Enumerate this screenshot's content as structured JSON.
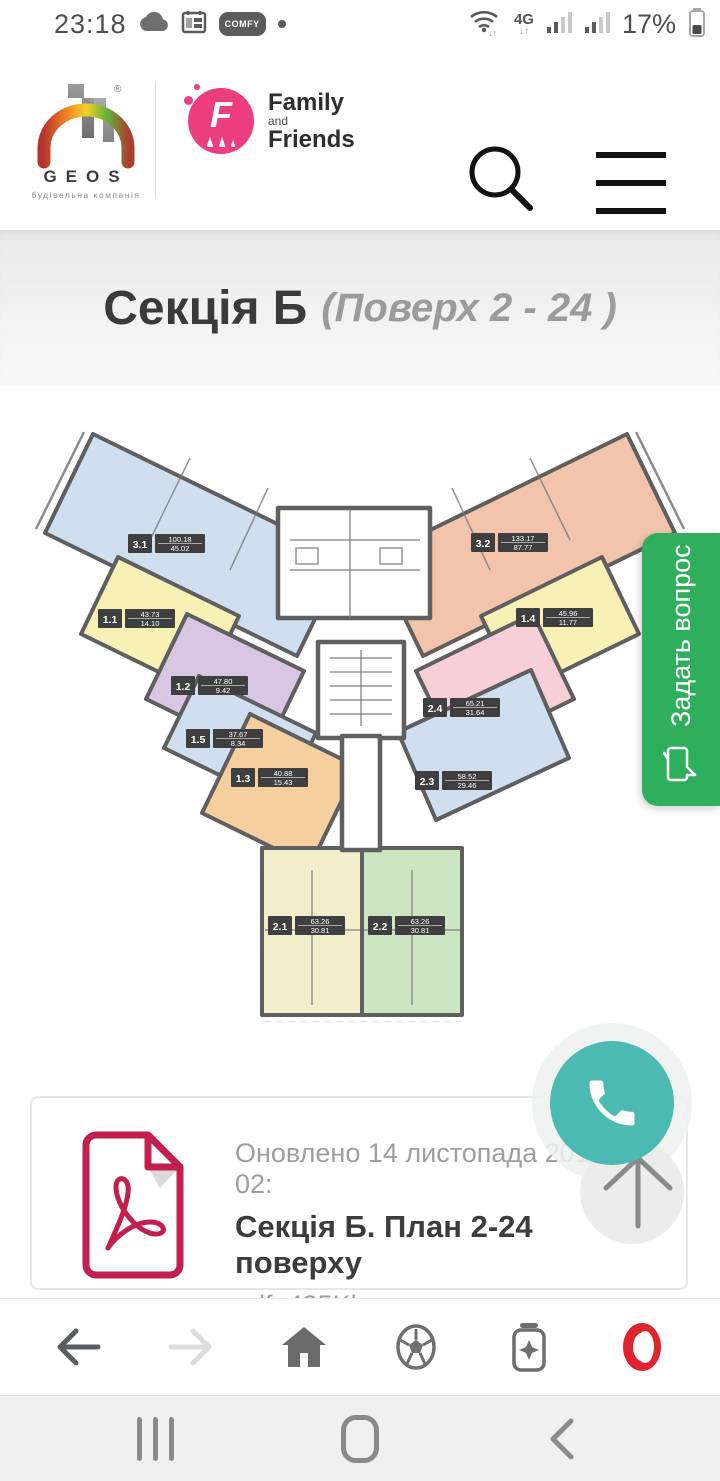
{
  "status_bar": {
    "time": "23:18",
    "carrier_badge": "COMFY",
    "network_type": "4G",
    "battery": "17%"
  },
  "header": {
    "geos_name": "GEOS",
    "geos_reg": "®",
    "geos_tagline": "будівельна компанія",
    "partner_family": "Family",
    "partner_and": "and",
    "partner_friends": "Friends"
  },
  "title": {
    "section": "Секція Б",
    "floors": "(Поверх 2 - 24 )"
  },
  "plan": {
    "units": [
      {
        "id": "3.1",
        "area_total": "100.18",
        "area_living": "45.02"
      },
      {
        "id": "1.1",
        "area_total": "43.73",
        "area_living": "14.10"
      },
      {
        "id": "1.2",
        "area_total": "47.80",
        "area_living": "9.42"
      },
      {
        "id": "1.5",
        "area_total": "37.67",
        "area_living": "8.34"
      },
      {
        "id": "1.3",
        "area_total": "40.88",
        "area_living": "15.43"
      },
      {
        "id": "3.2",
        "area_total": "133.17",
        "area_living": "87.77"
      },
      {
        "id": "1.4",
        "area_total": "45.96",
        "area_living": "11.77"
      },
      {
        "id": "2.4",
        "area_total": "65.21",
        "area_living": "31.64"
      },
      {
        "id": "2.3",
        "area_total": "58.52",
        "area_living": "29.46"
      },
      {
        "id": "2.1",
        "area_total": "63.26",
        "area_living": "30.81"
      },
      {
        "id": "2.2",
        "area_total": "63.26",
        "area_living": "30.81"
      }
    ]
  },
  "ask_button": {
    "label": "Задать вопрос"
  },
  "download_card": {
    "updated": "Оновлено 14 листопада 2018, 02:",
    "title": "Секція Б. План 2-24 поверху",
    "meta": "pdf. 435Kb"
  },
  "colors": {
    "accent_green": "#2fae5c",
    "fab_teal": "#4cb9b2",
    "opera_red": "#e0242f",
    "pdf_red": "#c21f4e",
    "partner_pink": "#ec3d80",
    "unit_blue": "#cfdff0",
    "unit_salmon": "#f2c4ab",
    "unit_yellow": "#f8f0b5",
    "unit_purple": "#d9c6e2",
    "unit_pink": "#f7cfd8",
    "unit_orange": "#f6cf9e",
    "unit_cream": "#f3efcd",
    "unit_green": "#cce6c2"
  }
}
